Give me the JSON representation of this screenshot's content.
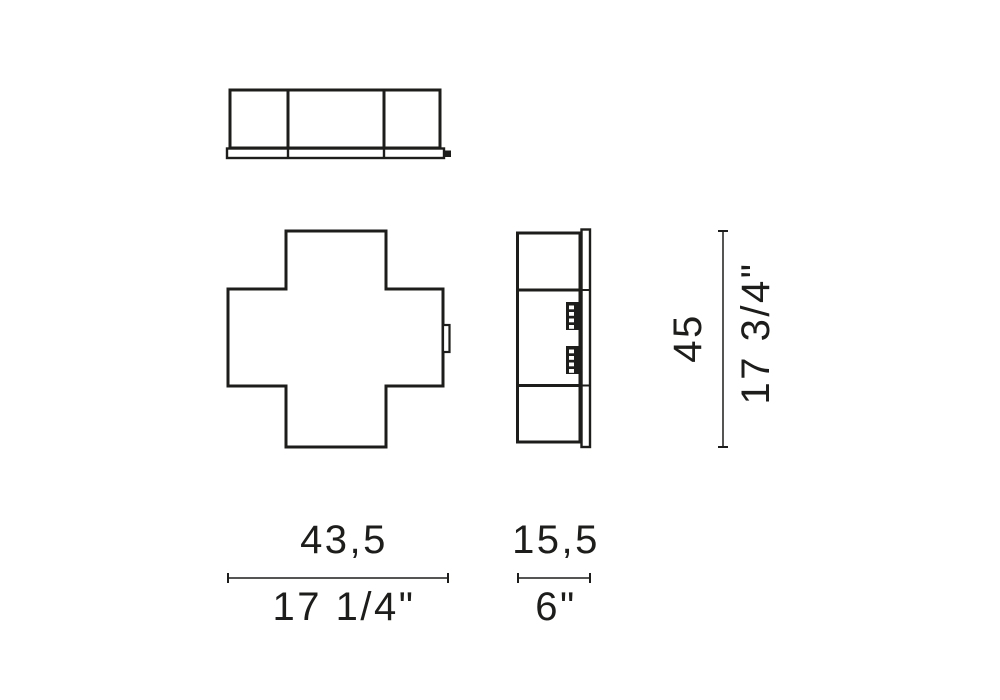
{
  "canvas": {
    "background": "#ffffff",
    "line_color": "#1d1d1b"
  },
  "dimensions": {
    "width": {
      "metric": "43,5",
      "imperial": "17 1/4\""
    },
    "depth": {
      "metric": "15,5",
      "imperial": "6\""
    },
    "height": {
      "metric": "45",
      "imperial": "17 3/4\""
    }
  }
}
